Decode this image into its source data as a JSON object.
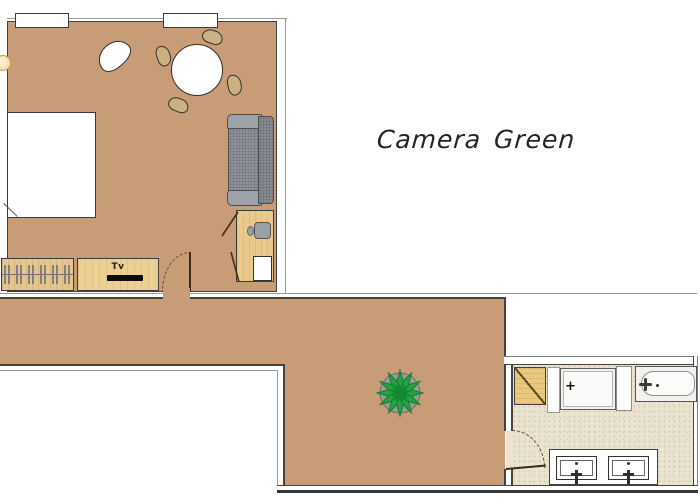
{
  "title": "Camera Green",
  "labels": {
    "camera_green": "Camera Green",
    "tv": "Tv",
    "shower_drain": "+"
  },
  "colors": {
    "floor_tan": "#c79c76",
    "wood_light": "#ecd094",
    "wood_mid": "#e5c68d",
    "wood_desk": "#e9c98c",
    "bath_floor": "#eae3d1",
    "bath_cabinet": "#eac87c",
    "sofa_seat": "#8e9399",
    "sofa_arm": "#9ea2a8",
    "sofa_back": "#878b91",
    "chair_tan": "#c9b183",
    "plant_green": "#25a244",
    "plant_dark": "#128a34",
    "pot_gray": "#9a9a94",
    "wall_dark": "#46423c",
    "wall_light": "#9a9a9a",
    "door_brown": "#6b4a23",
    "lamp_cream": "#f2d9a0"
  }
}
